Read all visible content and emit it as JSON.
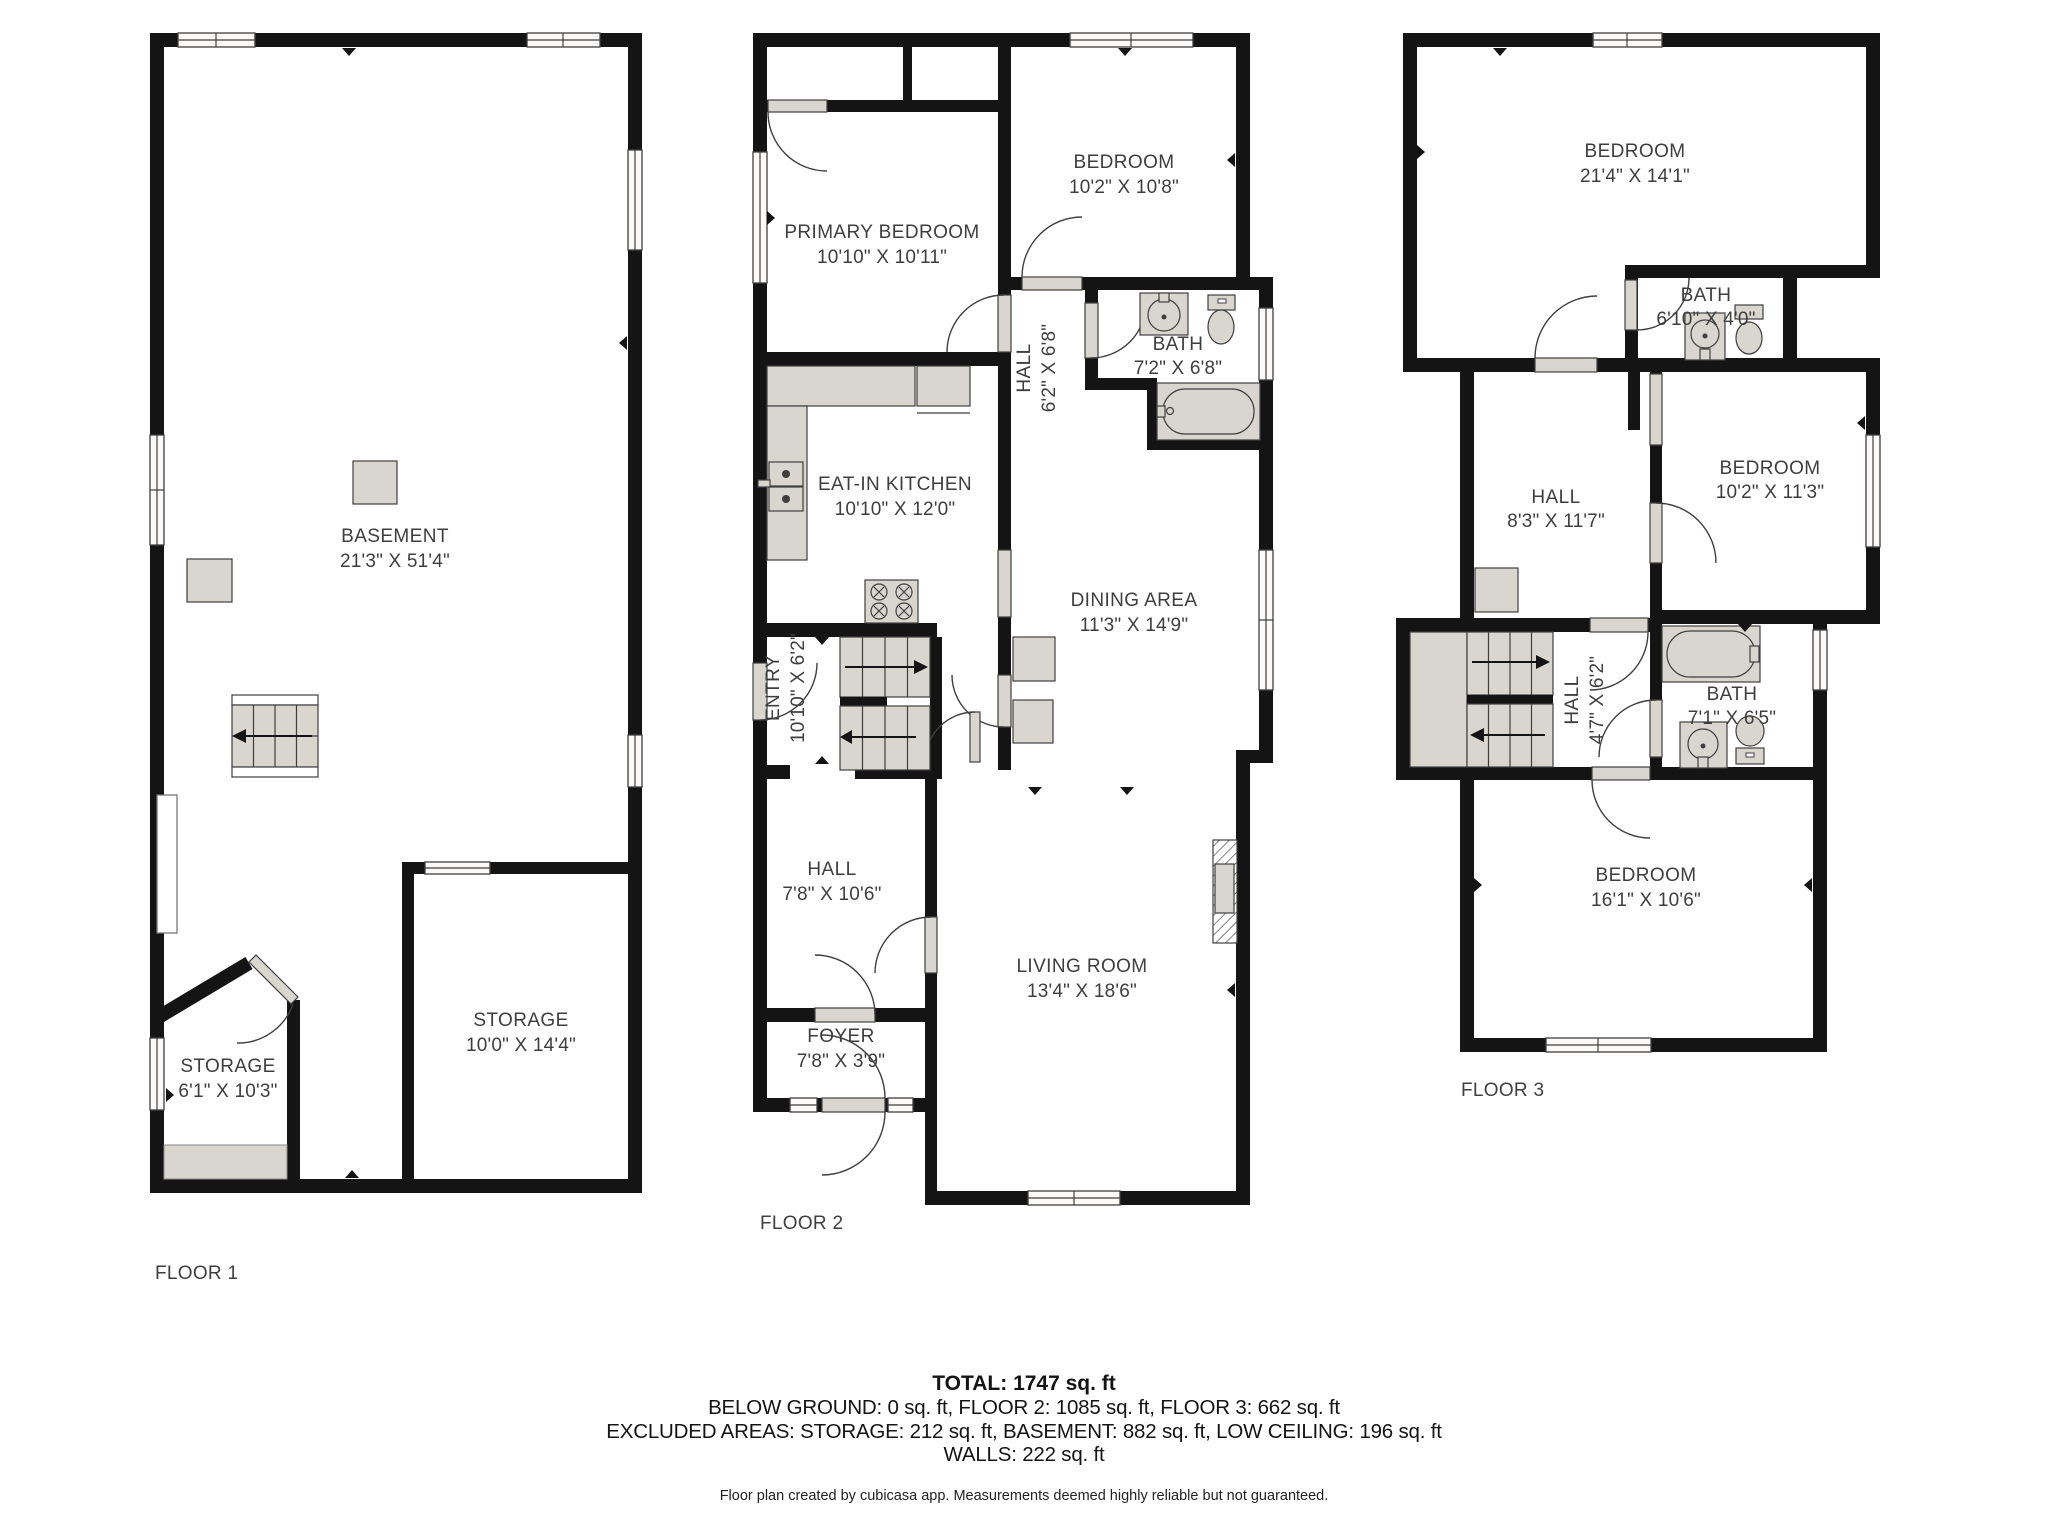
{
  "floor1": {
    "label": "FLOOR 1",
    "rooms": {
      "basement": {
        "name": "BASEMENT",
        "dims": "21'3\" X 51'4\""
      },
      "storage_small": {
        "name": "STORAGE",
        "dims": "6'1\" X 10'3\""
      },
      "storage_large": {
        "name": "STORAGE",
        "dims": "10'0\" X 14'4\""
      }
    }
  },
  "floor2": {
    "label": "FLOOR 2",
    "rooms": {
      "primary_bedroom": {
        "name": "PRIMARY BEDROOM",
        "dims": "10'10\" X 10'11\""
      },
      "bedroom": {
        "name": "BEDROOM",
        "dims": "10'2\" X 10'8\""
      },
      "bath": {
        "name": "BATH",
        "dims": "7'2\" X 6'8\""
      },
      "hall_upper": {
        "name": "HALL",
        "dims": "6'2\" X 6'8\""
      },
      "kitchen": {
        "name": "EAT-IN KITCHEN",
        "dims": "10'10\" X 12'0\""
      },
      "dining": {
        "name": "DINING AREA",
        "dims": "11'3\" X 14'9\""
      },
      "entry": {
        "name": "ENTRY",
        "dims": "10'10\" X 6'2\""
      },
      "hall_lower": {
        "name": "HALL",
        "dims": "7'8\" X 10'6\""
      },
      "foyer": {
        "name": "FOYER",
        "dims": "7'8\" X 3'9\""
      },
      "living": {
        "name": "LIVING ROOM",
        "dims": "13'4\" X 18'6\""
      }
    }
  },
  "floor3": {
    "label": "FLOOR 3",
    "rooms": {
      "bedroom_top": {
        "name": "BEDROOM",
        "dims": "21'4\" X 14'1\""
      },
      "bath_top": {
        "name": "BATH",
        "dims": "6'10\" X 4'0\""
      },
      "hall": {
        "name": "HALL",
        "dims": "8'3\" X 11'7\""
      },
      "bedroom_mid": {
        "name": "BEDROOM",
        "dims": "10'2\" X 11'3\""
      },
      "hall_small": {
        "name": "HALL",
        "dims": "4'7\" X 6'2\""
      },
      "bath_mid": {
        "name": "BATH",
        "dims": "7'1\" X 6'5\""
      },
      "bedroom_lower": {
        "name": "BEDROOM",
        "dims": "16'1\" X 10'6\""
      }
    }
  },
  "summary": {
    "total": "TOTAL: 1747 sq. ft",
    "floors_line": "BELOW GROUND: 0 sq. ft, FLOOR 2: 1085 sq. ft, FLOOR 3: 662 sq. ft",
    "excluded_line": "EXCLUDED AREAS: STORAGE: 212 sq. ft, BASEMENT: 882 sq. ft, LOW CEILING: 196 sq. ft",
    "walls_line": "WALLS: 222 sq. ft",
    "disclaimer": "Floor plan created by cubicasa app. Measurements deemed highly reliable but not guaranteed."
  },
  "colors": {
    "wall": "#141414",
    "fixture_gray": "#d9d6d0",
    "label_text": "#3e3e3e",
    "background": "#ffffff"
  }
}
